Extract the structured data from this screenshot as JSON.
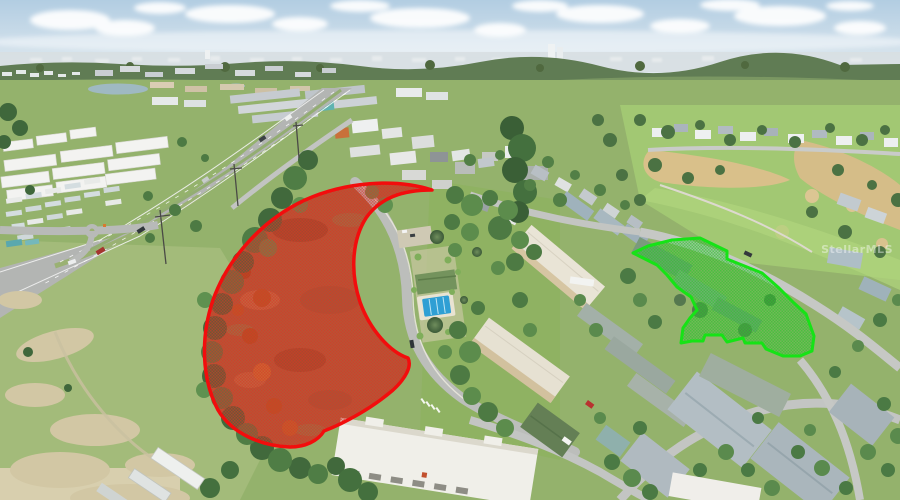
{
  "watermark": {
    "text": "StellarMLS"
  },
  "overlays": {
    "red_parcel": {
      "stroke_color": "#f20d0d",
      "fill_color": "#da3227"
    },
    "green_parcel": {
      "stroke_color": "#16e316",
      "fill_color": "#2fc42f"
    }
  },
  "scene": {
    "sky_color": "#b2cde2",
    "grass_color": "#94b26c",
    "road_color": "#b3b5b3",
    "dirt_parcel_color": "#a5653c",
    "sand_color": "#d2c7a4",
    "pool_color": "#2f9fd4"
  }
}
